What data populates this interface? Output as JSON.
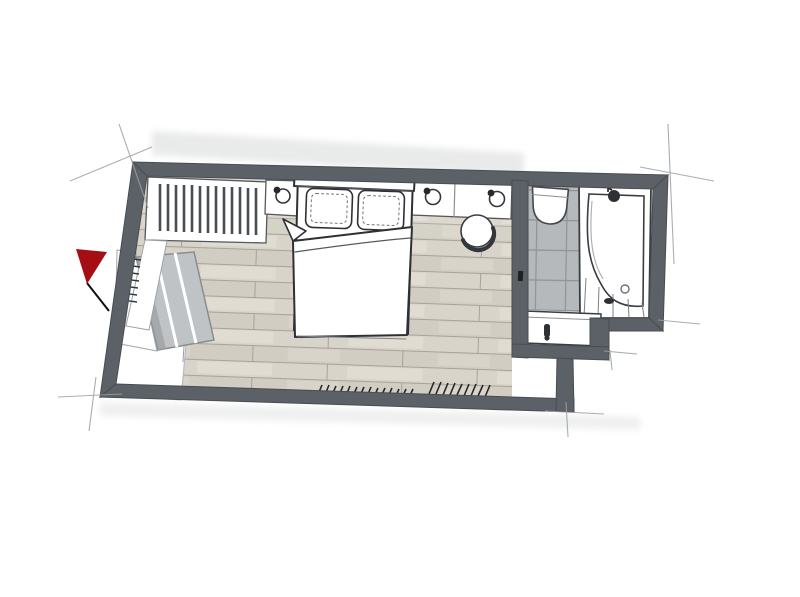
{
  "meta": {
    "title": "Hand-drawn watercolor floor plan of a bedroom with en-suite bathroom",
    "drawing_style": "pencil and marker sketch, top-down plan view",
    "visible_text": ""
  },
  "palette": {
    "background": "#ffffff",
    "wall": "#5c6167",
    "wall_dark": "#43474c",
    "floor_base": "#d6d2c7",
    "floor_seam": "#a7a399",
    "tile": "#b5b9bb",
    "tile_grout": "#8f9396",
    "fixture_fill": "#ffffff",
    "fixture_outline": "#3a3d40",
    "bench": "#c0c3c5",
    "bench_shadow": "#9b9ea1",
    "flag_red": "#a50f14",
    "pencil": "#8e9497",
    "shadow": "#e2e3e4",
    "ink": "#222222"
  },
  "marker": {
    "type": "red-flag",
    "position": "outside left wall"
  },
  "rooms": {
    "bedroom": {
      "name": "bedroom",
      "floor": "light oak plank flooring, horizontal boards",
      "items": [
        "wardrobe with clothes rail and hangers",
        "left nightstand with table lamp",
        "double bed with two pillows and folded duvet",
        "right console nightstand with two table lamps",
        "round chair / stool",
        "upholstered bench with three cushions",
        "wall shelf behind bench",
        "entry strip / door zone",
        "radiator hatch marks along bottom wall",
        "hook marks on left wall"
      ]
    },
    "bathroom": {
      "name": "bathroom",
      "floor": "grey tiled shower zone, white deck around tub",
      "items": [
        "tiled shower area",
        "wall-hung toilet",
        "corner bathtub with faucet",
        "washbasin with faucet"
      ]
    }
  }
}
